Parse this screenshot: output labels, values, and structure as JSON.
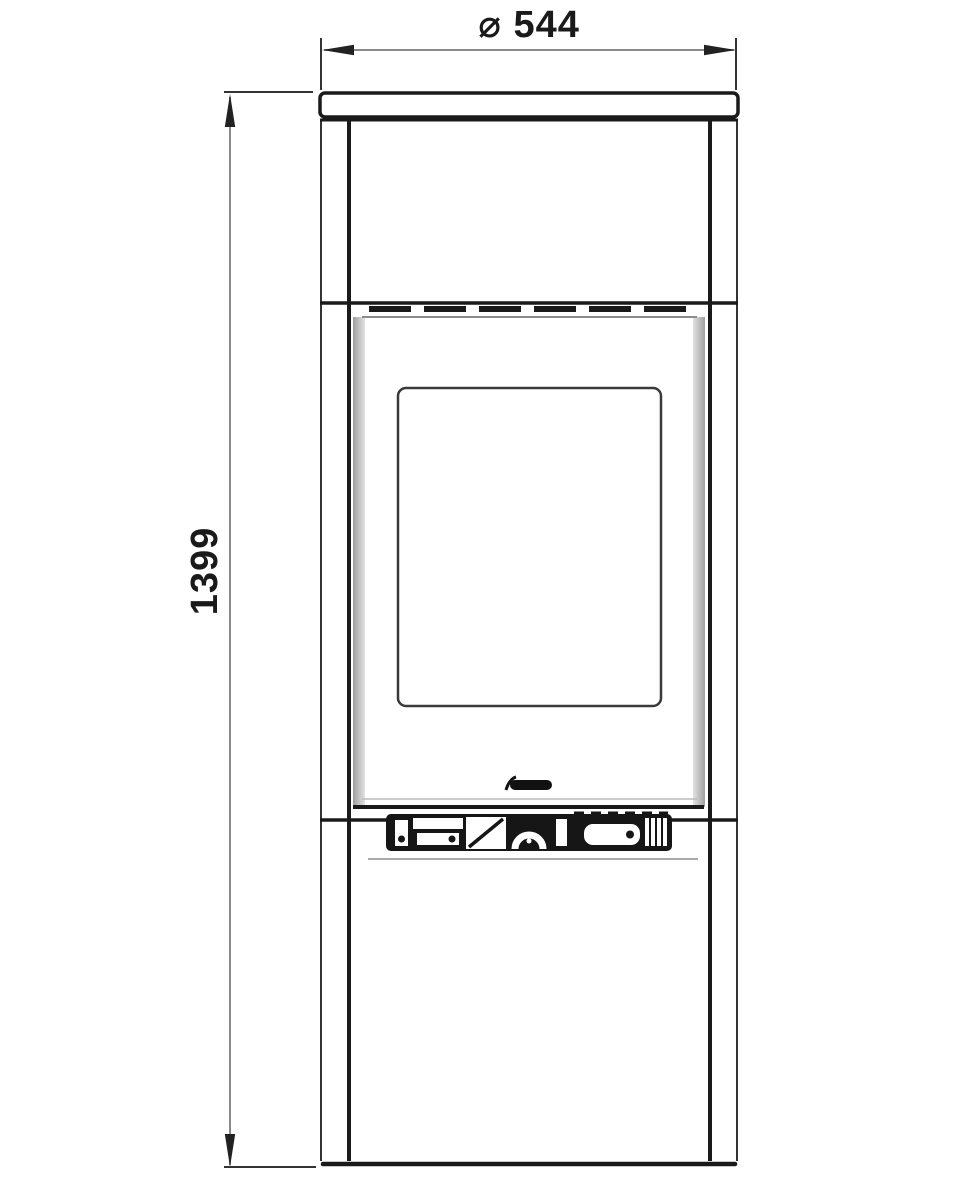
{
  "drawing": {
    "subject": "stove-front-elevation-technical-drawing",
    "background": "#ffffff"
  },
  "dimensions": {
    "width": {
      "label": "⌀ 544",
      "value": 544
    },
    "height": {
      "label": "1399",
      "value": 1399
    }
  },
  "colors": {
    "line_dark": "#1a1a1a",
    "line_medium": "#333333",
    "dimension_line": "#8a8a8a",
    "shade_grey": "#a6a6a6",
    "glass_border": "#3a3a3a",
    "background": "#ffffff"
  }
}
